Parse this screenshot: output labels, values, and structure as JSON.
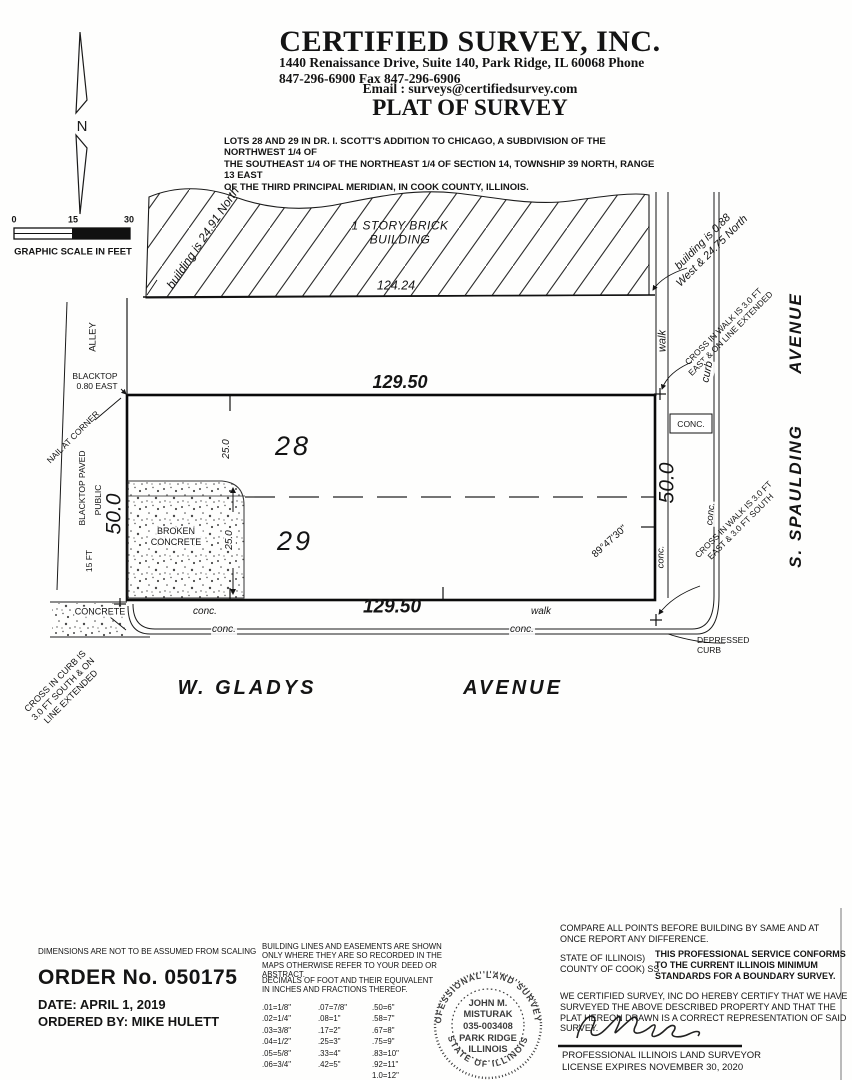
{
  "header": {
    "company": "CERTIFIED SURVEY, INC.",
    "address_line": "1440 Renaissance Drive, Suite 140, Park Ridge, IL 60068   Phone 847-296-6900  Fax 847-296-6906",
    "email_line": "Email : surveys@certifiedsurvey.com",
    "title": "PLAT OF SURVEY"
  },
  "legal_description": "LOTS 28 AND 29 IN DR. I. SCOTT'S ADDITION TO CHICAGO, A SUBDIVISION OF THE NORTHWEST 1/4 OF\nTHE SOUTHEAST 1/4 OF THE NORTHEAST 1/4 OF SECTION 14, TOWNSHIP 39 NORTH, RANGE 13 EAST\nOF THE THIRD PRINCIPAL MERIDIAN, IN COOK COUNTY, ILLINOIS.",
  "north_label": "N",
  "scale": {
    "tick0": "0",
    "tick15": "15",
    "tick30": "30",
    "caption": "GRAPHIC SCALE IN FEET"
  },
  "drawing": {
    "building_offset_nw": "building is 24.91 North",
    "building_label": "1 STORY BRICK\nBUILDING",
    "dim_building": "124.24",
    "building_offset_ne": "building is 0.88\nWest & 24.75 North",
    "cross_walk_ne": "CROSS IN WALK IS 3.0 FT\nEAST & ON LINE EXTENDED",
    "walk_e": "walk",
    "curb_e": "curb",
    "avenue_e": "AVENUE",
    "spaulding_e": "S. SPAULDING",
    "conc_box": "CONC.",
    "dim_top": "129.50",
    "lot28": "28",
    "dim_lot28": "25.0",
    "lot29": "29",
    "dim_lot29": "25.0",
    "broken_concrete": "BROKEN\nCONCRETE",
    "dim_west": "50.0",
    "dim_east": "50.0",
    "angle_se": "89°47'30\"",
    "conc_e1": "conc.",
    "conc_e2": "conc.",
    "cross_walk_se": "CROSS IN WALK IS 3.0 FT\nEAST & 3.0 FT SOUTH",
    "alley": "ALLEY",
    "blacktop_ne": "BLACKTOP\n0.80 EAST",
    "nail": "NAIL AT CORNER",
    "blacktop_paved": "BLACKTOP PAVED",
    "public_lbl": "PUBLIC",
    "fifteen_ft": "15 FT",
    "dim_bottom": "129.50",
    "conc_s1": "conc.",
    "conc_s2": "conc.",
    "walk_s": "walk",
    "conc_s3": "conc.",
    "concrete_sw": "CONCRETE",
    "cross_curb_sw": "CROSS IN CURB IS\n3.0 FT SOUTH & ON\nLINE EXTENDED",
    "gladys": "W. GLADYS",
    "avenue_s": "AVENUE",
    "depressed": "DEPRESSED\nCURB"
  },
  "notes": {
    "no_scaling": "DIMENSIONS ARE NOT TO BE ASSUMED FROM SCALING",
    "building_lines": "BUILDING LINES AND EASEMENTS ARE SHOWN ONLY WHERE THEY ARE SO RECORDED IN THE MAPS OTHERWISE REFER TO YOUR DEED OR ABSTRACT."
  },
  "order": {
    "number": "ORDER No. 050175",
    "date": "DATE: APRIL 1, 2019",
    "ordered_by": "ORDERED BY: MIKE HULETT"
  },
  "decimals": {
    "title": "DECIMALS OF FOOT AND THEIR EQUIVALENT\nIN INCHES AND FRACTIONS THEREOF.",
    "col1": [
      ".01=1/8\"",
      ".02=1/4\"",
      ".03=3/8\"",
      ".04=1/2\"",
      ".05=5/8\"",
      ".06=3/4\""
    ],
    "col2": [
      ".07=7/8\"",
      ".08=1\"",
      ".17=2\"",
      ".25=3\"",
      ".33=4\"",
      ".42=5\""
    ],
    "col3": [
      ".50=6\"",
      ".58=7\"",
      ".67=8\"",
      ".75=9\"",
      ".83=10\"",
      ".92=11\"",
      "1.0=12\""
    ]
  },
  "seal": {
    "ring_top": "PROFESSIONAL LAND SURVEYOR",
    "ring_bottom": "STATE OF ILLINOIS",
    "lines": [
      "JOHN M.",
      "MISTURAK",
      "035-003408",
      "PARK RIDGE",
      "ILLINOIS"
    ]
  },
  "cert": {
    "compare": "COMPARE ALL POINTS BEFORE BUILDING BY SAME AND AT ONCE REPORT ANY DIFFERENCE.",
    "state": "STATE OF ILLINOIS)\nCOUNTY OF COOK) SS",
    "conforms": "THIS PROFESSIONAL SERVICE CONFORMS TO THE CURRENT ILLINOIS MINIMUM STANDARDS FOR A BOUNDARY SURVEY.",
    "certify": "WE CERTIFIED SURVEY, INC DO HEREBY CERTIFY THAT WE HAVE SURVEYED THE ABOVE DESCRIBED PROPERTY AND THAT THE PLAT HEREON DRAWN IS A CORRECT REPRESENTATION OF SAID SURVEY.",
    "surveyor_title": "PROFESSIONAL ILLINOIS LAND SURVEYOR",
    "license": "LICENSE EXPIRES NOVEMBER 30, 2020"
  }
}
